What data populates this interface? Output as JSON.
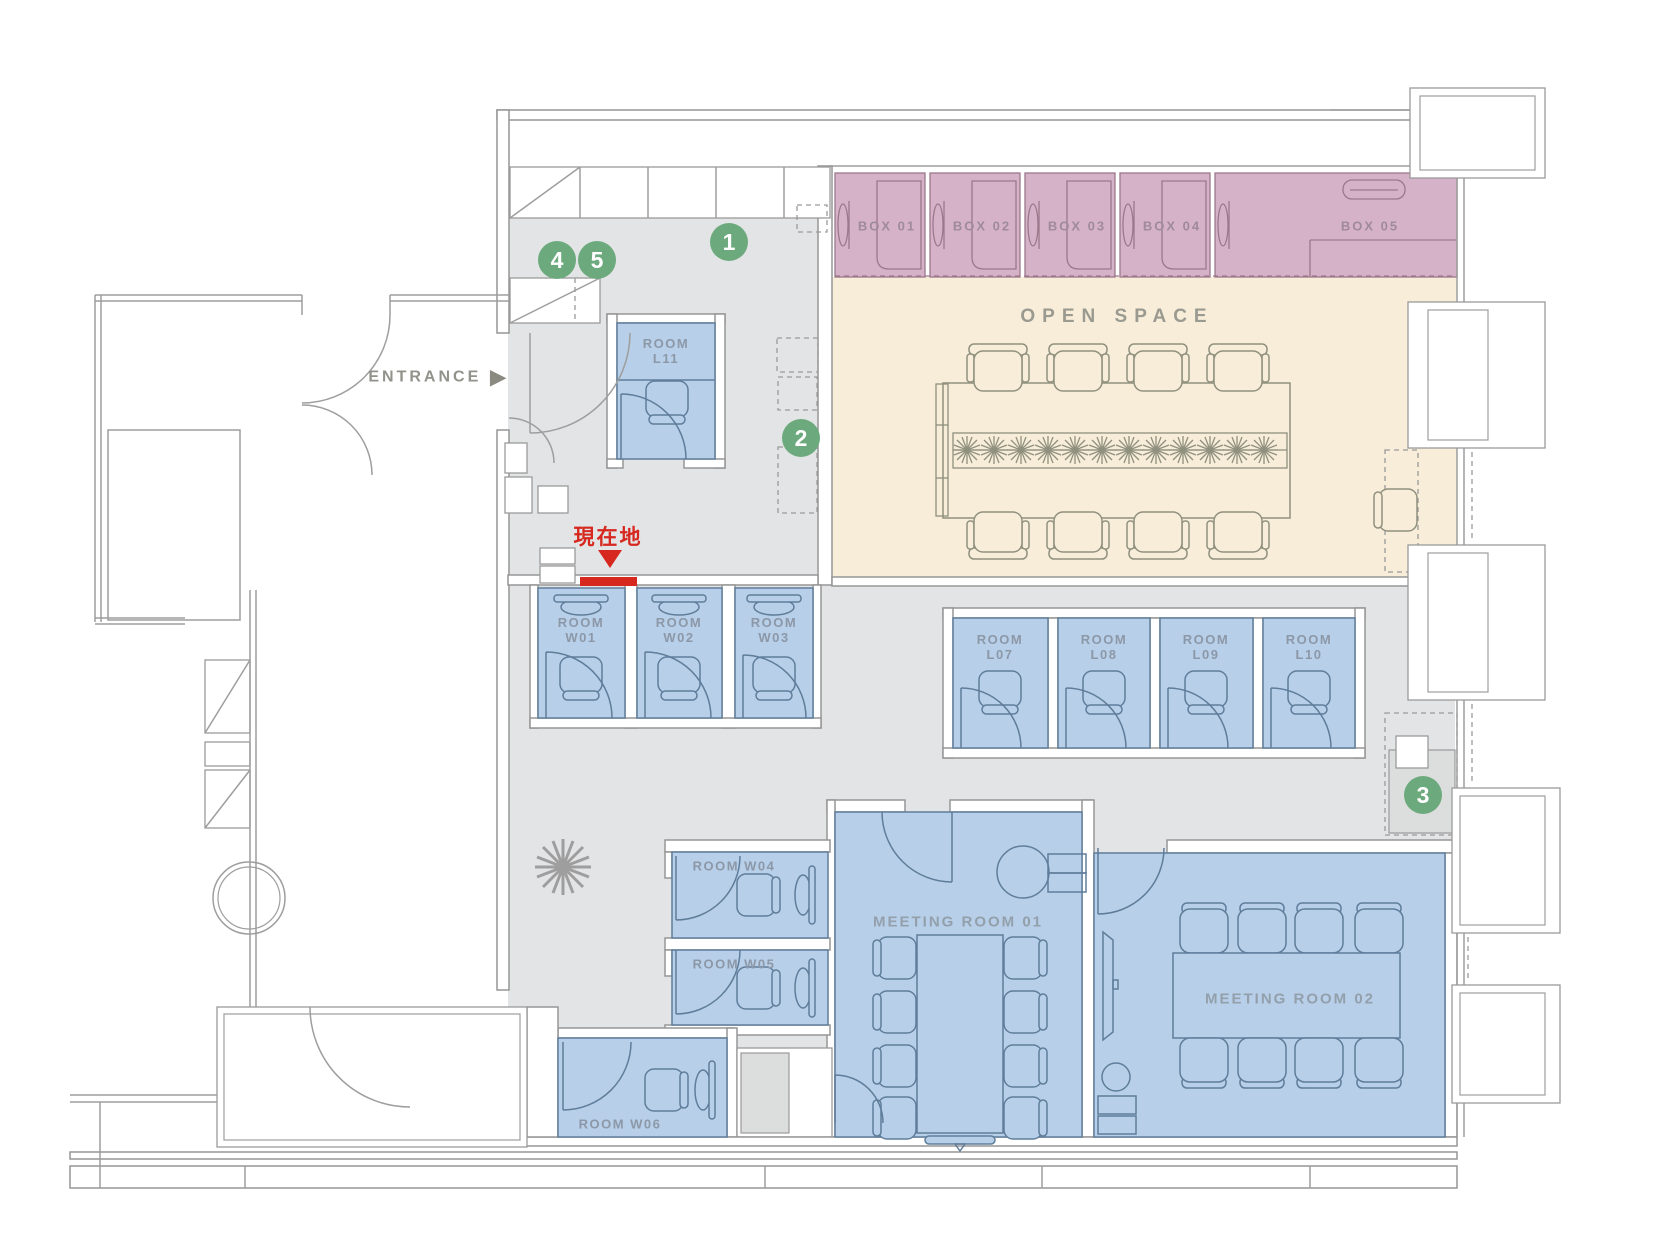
{
  "labels": {
    "entrance": "ENTRANCE",
    "entrance_arrow": "▶",
    "open_space": "OPEN SPACE",
    "current_location": "現在地"
  },
  "boxes": [
    {
      "label": "BOX 01"
    },
    {
      "label": "BOX 02"
    },
    {
      "label": "BOX 03"
    },
    {
      "label": "BOX 04"
    },
    {
      "label": "BOX 05"
    }
  ],
  "rooms": {
    "l11": "ROOM\nL11",
    "w_row": [
      "ROOM\nW01",
      "ROOM\nW02",
      "ROOM\nW03"
    ],
    "l_row": [
      "ROOM\nL07",
      "ROOM\nL08",
      "ROOM\nL09",
      "ROOM\nL10"
    ],
    "w04": "ROOM W04",
    "w05": "ROOM W05",
    "w06": "ROOM W06",
    "meeting_01": "MEETING ROOM 01",
    "meeting_02": "MEETING ROOM 02"
  },
  "legend": {
    "markers": [
      {
        "number": "1"
      },
      {
        "number": "2"
      },
      {
        "number": "3"
      },
      {
        "number": "4"
      },
      {
        "number": "5"
      }
    ]
  },
  "colors": {
    "floor_gray": "#e3e4e5",
    "open_space_beige": "#f7edd8",
    "phone_box_pink": "#d6b2c8",
    "room_blue": "#b7cfe8",
    "marker_green": "#6caa7d",
    "current_location_red": "#d6281e",
    "wall_line": "#969696"
  }
}
